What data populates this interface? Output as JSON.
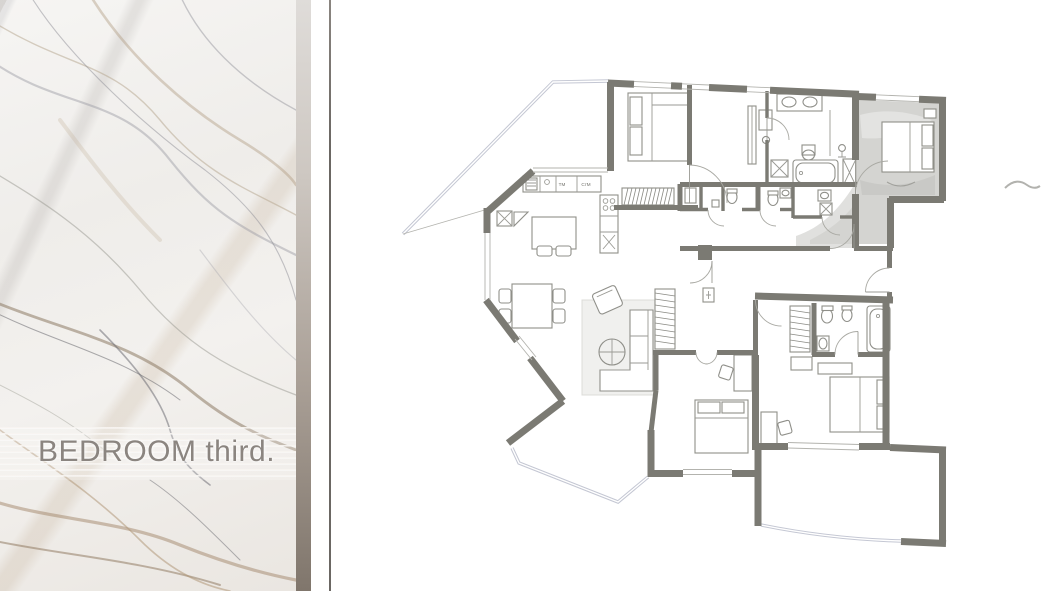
{
  "panel": {
    "title": "BEDROOM third."
  },
  "plan": {
    "labels": {
      "kitchen_appliance_left": "ТМ",
      "kitchen_appliance_right": "СтМ"
    },
    "highlighted_room": "third-bedroom"
  },
  "colors": {
    "wall": "#7b7a73",
    "divider_band_top": "#dfdcd9",
    "divider_band_bottom": "#80766c",
    "thin_rule": "#6b6763",
    "title_text": "#8b8580",
    "highlight_wash": "#cfcfcc",
    "glazing": "#c4c7d3",
    "background": "#ffffff"
  }
}
